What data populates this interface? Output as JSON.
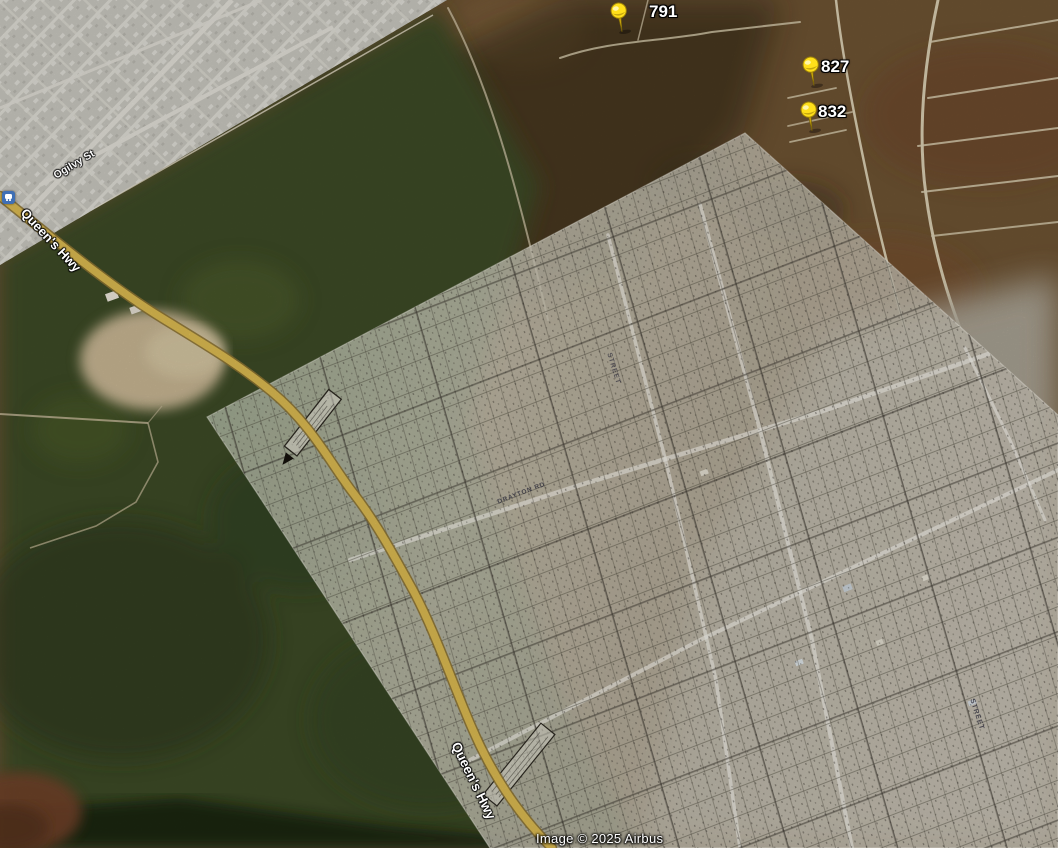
{
  "view": {
    "type": "satellite-map-with-plat-overlay",
    "attribution": "Image © 2025 Airbus"
  },
  "placemarks": [
    {
      "label": "791"
    },
    {
      "label": "827"
    },
    {
      "label": "832"
    }
  ],
  "road_labels": {
    "queens_hwy_top": "Queen's Hwy",
    "queens_hwy_bottom": "Queen's Hwy",
    "ogilvy_st": "Ogilvy St"
  },
  "overlay_labels": {
    "drayton_rd": "DRAYTON RD",
    "street_1": "STREET",
    "street_2": "STREET"
  },
  "icons": {
    "placemark_pin": "yellow-pushpin",
    "transit_stop": "bus-stop-icon"
  },
  "colors": {
    "pushpin": "#ffdf1a",
    "highway": "#e3c153",
    "label_text": "#ffffff",
    "overlay_paper": "#cfccbc",
    "transit_icon_bg": "#3f6fb5",
    "forest": "#3d4b27",
    "scrub": "#6f5433"
  }
}
